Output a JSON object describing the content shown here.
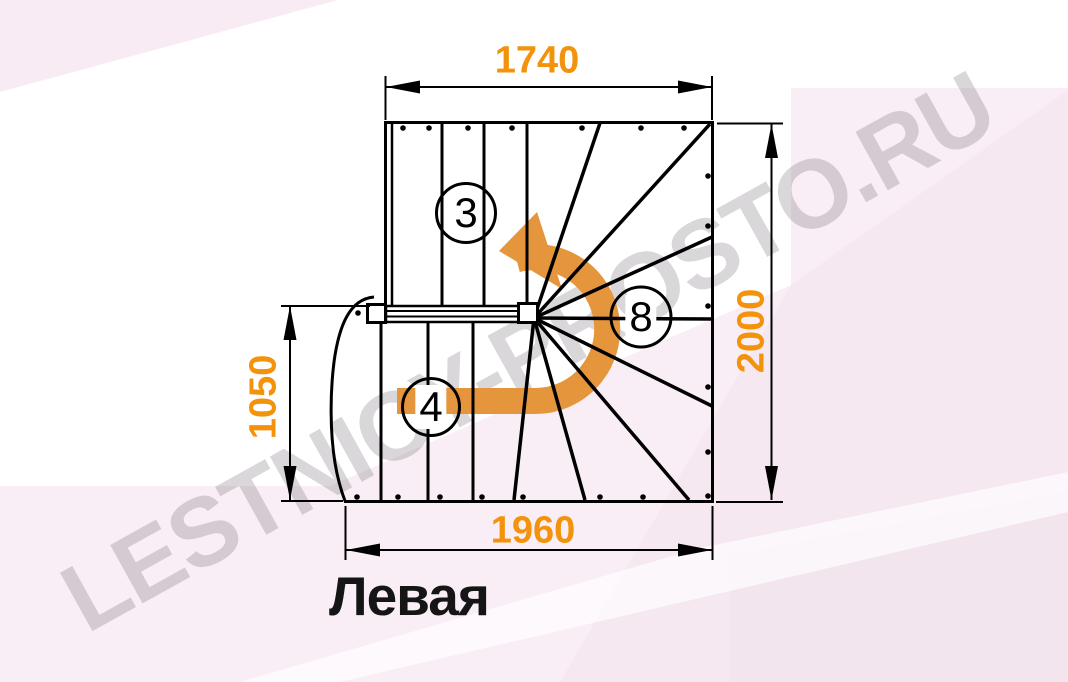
{
  "diagram": {
    "caption": "Левая",
    "watermark": "LESTNICY-PROSTO.RU",
    "dimensions": {
      "top": "1740",
      "right": "2000",
      "left": "1050",
      "bottom": "1960"
    },
    "step_labels": {
      "upper_flight": "3",
      "winder": "8",
      "lower_flight": "4"
    },
    "colors": {
      "dimension_text": "#F2930B",
      "rotation_arrow": "#E5953B",
      "linework": "#000000",
      "background_tint": "#F9EEF5",
      "watermark_gray": "#DCD8DB"
    }
  }
}
